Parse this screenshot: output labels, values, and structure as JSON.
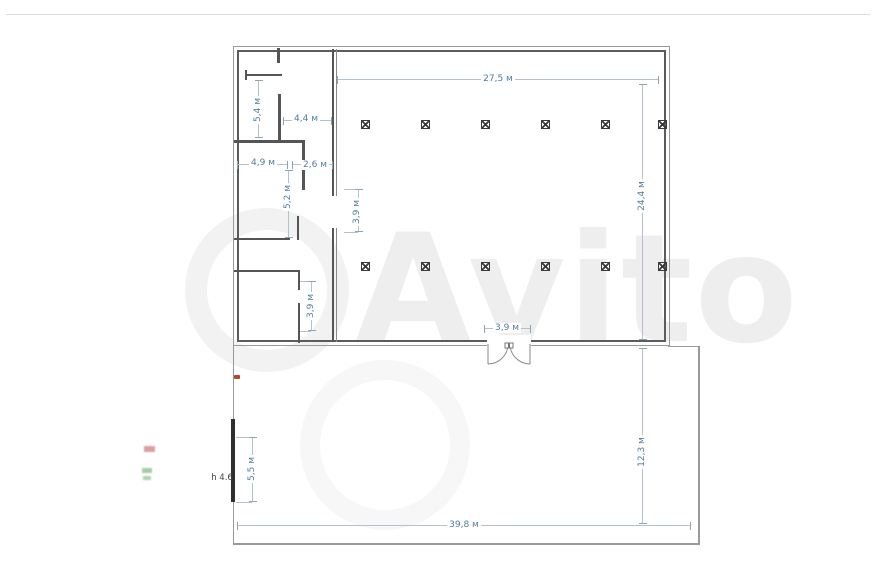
{
  "watermark": {
    "text": "Avito"
  },
  "floor_plan": {
    "dim_text_color": "#4e7e9e",
    "wall_color": "#5c5c5c",
    "dim_line_color": "#b4c0ca",
    "hall": {
      "width_label": "27,5 м",
      "depth_label": "24,4 м",
      "door_width_label": "3,9 м",
      "column_rows": 2,
      "columns_per_row": 6
    },
    "rooms": {
      "room_a_width_label": "4,4 м",
      "room_a_depth_label": "5,4 м",
      "room_b_width_label": "4,9 м",
      "room_c_width_label": "2,6 м",
      "room_b_depth_label": "5,2 м",
      "corridor_opening_label": "3,9 м",
      "storage_depth_label": "3,9 м"
    },
    "yard": {
      "width_label": "39,8 м",
      "depth_label": "12,3 м",
      "gate_opening_label": "5,5 м",
      "gate_height_label": "h 4.6"
    },
    "markers": {
      "red_dot_color": "#b5462c",
      "red_note_color": "#c05050",
      "green_note_color": "#4a9a55"
    }
  }
}
